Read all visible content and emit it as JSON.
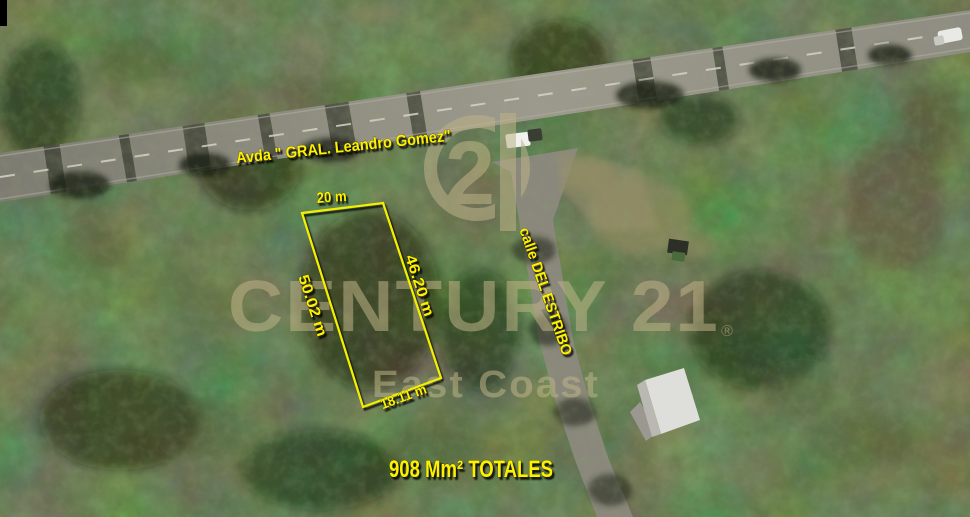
{
  "annotations": {
    "avenue_label": "Avda \" GRAL. Leandro Gomez\"",
    "street_label": "calle DEL ESTRIBO",
    "total_area_label": "908 Mm² TOTALES",
    "color": "#fdf000"
  },
  "parcel": {
    "top_length": "20 m",
    "right_length": "46.20 m",
    "left_length": "50.02 m",
    "bottom_length": "18.11 m",
    "outline_color": "#f3ef00"
  },
  "watermark": {
    "brand_name": "CENTURY 21",
    "registered_mark": "®",
    "office_name": "East Coast",
    "seal_digit": "2",
    "color": "#beb287"
  }
}
